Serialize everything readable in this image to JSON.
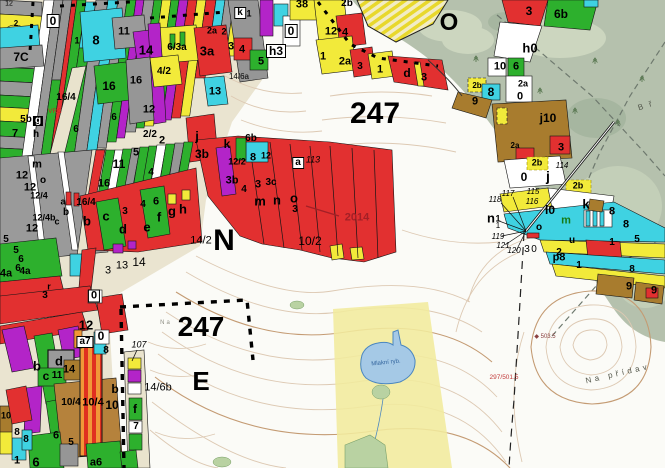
{
  "map": {
    "type": "forest-management-cadastral-map",
    "palette": {
      "parcel_red": "#e23030",
      "parcel_green": "#2db02d",
      "parcel_cyan": "#3fd2e2",
      "parcel_yellow": "#f2ea3a",
      "parcel_gray": "#9a9a9a",
      "parcel_magenta": "#b324c8",
      "parcel_brown": "#a87c2e",
      "parcel_ochre": "#b5823c",
      "stripe_orange": "#f09838",
      "road_beige": "#e9e3cd",
      "outside_green": "#b5c1ad",
      "meadow_band_yellow": "#f1eb9d",
      "pond_blue": "#a5c9e6",
      "contour_light": "#ddc9b3",
      "contour_index": "#c49b73",
      "year_marker_red": "#a31f26"
    },
    "big_labels": [
      "247",
      "N",
      "247",
      "E",
      "O"
    ],
    "year_marker": "2014",
    "pond_name": "Mlakní ryb.",
    "place_names": [
      "Na přídav",
      "B ř",
      "Na"
    ],
    "spot_heights": [
      "◆ 503.5",
      "297/501.5"
    ],
    "labels": [
      {
        "t": "247",
        "x": 375,
        "y": 114,
        "s": 30
      },
      {
        "t": "N",
        "x": 224,
        "y": 241,
        "s": 30
      },
      {
        "t": "247",
        "x": 201,
        "y": 327,
        "s": 28
      },
      {
        "t": "E",
        "x": 201,
        "y": 381,
        "s": 26
      },
      {
        "t": "O",
        "x": 449,
        "y": 23,
        "s": 24
      },
      {
        "t": "2014",
        "x": 357,
        "y": 218,
        "s": 11,
        "c": "#a31f26"
      },
      {
        "t": "12",
        "x": 9,
        "y": 4,
        "s": 7,
        "w": "n"
      },
      {
        "t": "2",
        "x": 16,
        "y": 24,
        "s": 8
      },
      {
        "t": "0",
        "x": 53,
        "y": 21,
        "s": 12,
        "bx": 1
      },
      {
        "t": "8",
        "x": 96,
        "y": 40,
        "s": 13
      },
      {
        "t": "1",
        "x": 77,
        "y": 41,
        "s": 9
      },
      {
        "t": "11",
        "x": 124,
        "y": 32,
        "s": 11
      },
      {
        "t": "14",
        "x": 146,
        "y": 50,
        "s": 13
      },
      {
        "t": "6/3a",
        "x": 177,
        "y": 48,
        "s": 10
      },
      {
        "t": "3a",
        "x": 207,
        "y": 51,
        "s": 13
      },
      {
        "t": "2a",
        "x": 212,
        "y": 31,
        "s": 9
      },
      {
        "t": "2",
        "x": 224,
        "y": 32,
        "s": 9
      },
      {
        "t": "k",
        "x": 240,
        "y": 13,
        "s": 10,
        "bx": 1
      },
      {
        "t": "1",
        "x": 249,
        "y": 14,
        "s": 9
      },
      {
        "t": "7C",
        "x": 21,
        "y": 57,
        "s": 12
      },
      {
        "t": "16",
        "x": 109,
        "y": 86,
        "s": 12
      },
      {
        "t": "16",
        "x": 136,
        "y": 81,
        "s": 11
      },
      {
        "t": "13",
        "x": 215,
        "y": 92,
        "s": 11
      },
      {
        "t": "4/2",
        "x": 164,
        "y": 72,
        "s": 10
      },
      {
        "t": "12",
        "x": 149,
        "y": 110,
        "s": 11
      },
      {
        "t": "16/4",
        "x": 66,
        "y": 98,
        "s": 10
      },
      {
        "t": "5b",
        "x": 26,
        "y": 120,
        "s": 10
      },
      {
        "t": "g",
        "x": 38,
        "y": 121,
        "s": 10,
        "inv": 1
      },
      {
        "t": "VRC",
        "x": 55,
        "y": 112,
        "s": 6.5,
        "c": "#cc2222",
        "w": "n"
      },
      {
        "t": "7",
        "x": 15,
        "y": 134,
        "s": 11
      },
      {
        "t": "h",
        "x": 36,
        "y": 135,
        "s": 10
      },
      {
        "t": "6",
        "x": 76,
        "y": 130,
        "s": 10
      },
      {
        "t": "6",
        "x": 114,
        "y": 118,
        "s": 10
      },
      {
        "t": "2/2",
        "x": 150,
        "y": 135,
        "s": 10
      },
      {
        "t": "2",
        "x": 162,
        "y": 141,
        "s": 11
      },
      {
        "t": "j",
        "x": 197,
        "y": 136,
        "s": 13
      },
      {
        "t": "3b",
        "x": 202,
        "y": 154,
        "s": 12
      },
      {
        "t": "14/6a",
        "x": 239,
        "y": 77,
        "s": 8,
        "w": "n"
      },
      {
        "t": "4",
        "x": 242,
        "y": 50,
        "s": 11
      },
      {
        "t": "3",
        "x": 231,
        "y": 47,
        "s": 11
      },
      {
        "t": "5",
        "x": 261,
        "y": 62,
        "s": 11
      },
      {
        "t": "6b",
        "x": 251,
        "y": 139,
        "s": 10
      },
      {
        "t": "h3",
        "x": 276,
        "y": 51,
        "s": 12,
        "bx": 1
      },
      {
        "t": "38",
        "x": 302,
        "y": 5,
        "s": 11
      },
      {
        "t": "0",
        "x": 291,
        "y": 31,
        "s": 12,
        "bx": 1
      },
      {
        "t": "12",
        "x": 331,
        "y": 32,
        "s": 11
      },
      {
        "t": "4",
        "x": 345,
        "y": 33,
        "s": 11
      },
      {
        "t": "2b",
        "x": 347,
        "y": 4,
        "s": 10
      },
      {
        "t": "1",
        "x": 323,
        "y": 57,
        "s": 11
      },
      {
        "t": "2a",
        "x": 345,
        "y": 62,
        "s": 11
      },
      {
        "t": "3",
        "x": 360,
        "y": 67,
        "s": 10
      },
      {
        "t": "1",
        "x": 380,
        "y": 70,
        "s": 11
      },
      {
        "t": "d",
        "x": 407,
        "y": 73,
        "s": 12
      },
      {
        "t": "3",
        "x": 424,
        "y": 78,
        "s": 11
      },
      {
        "t": "k",
        "x": 227,
        "y": 144,
        "s": 12
      },
      {
        "t": "12/2",
        "x": 237,
        "y": 162,
        "s": 9
      },
      {
        "t": "8",
        "x": 253,
        "y": 158,
        "s": 11
      },
      {
        "t": "12",
        "x": 266,
        "y": 156,
        "s": 9
      },
      {
        "t": "3b",
        "x": 232,
        "y": 181,
        "s": 11
      },
      {
        "t": "4",
        "x": 244,
        "y": 190,
        "s": 10
      },
      {
        "t": "3",
        "x": 258,
        "y": 185,
        "s": 11
      },
      {
        "t": "3c",
        "x": 271,
        "y": 183,
        "s": 10
      },
      {
        "t": "m",
        "x": 260,
        "y": 201,
        "s": 13
      },
      {
        "t": "n",
        "x": 277,
        "y": 200,
        "s": 13
      },
      {
        "t": "o",
        "x": 294,
        "y": 198,
        "s": 13
      },
      {
        "t": "3",
        "x": 295,
        "y": 210,
        "s": 10
      },
      {
        "t": "a",
        "x": 298,
        "y": 163,
        "s": 10,
        "bx": 1
      },
      {
        "t": "113",
        "x": 313,
        "y": 160,
        "s": 9,
        "i": 1,
        "w": "n"
      },
      {
        "t": "14/2",
        "x": 201,
        "y": 241,
        "s": 11,
        "w": "n"
      },
      {
        "t": "10/2",
        "x": 310,
        "y": 241,
        "s": 12,
        "w": "n"
      },
      {
        "t": "3",
        "x": 108,
        "y": 271,
        "s": 11,
        "w": "n"
      },
      {
        "t": "13",
        "x": 122,
        "y": 266,
        "s": 11,
        "w": "n"
      },
      {
        "t": "14",
        "x": 139,
        "y": 262,
        "s": 12,
        "w": "n"
      },
      {
        "t": "Na",
        "x": 166,
        "y": 323,
        "s": 6,
        "c": "#8f8f85",
        "ls": 2,
        "w": "n"
      },
      {
        "t": "m",
        "x": 37,
        "y": 165,
        "s": 11
      },
      {
        "t": "12",
        "x": 22,
        "y": 176,
        "s": 11
      },
      {
        "t": "o",
        "x": 43,
        "y": 181,
        "s": 10
      },
      {
        "t": "12",
        "x": 30,
        "y": 188,
        "s": 11
      },
      {
        "t": "12/4",
        "x": 39,
        "y": 196,
        "s": 9
      },
      {
        "t": "12/4b",
        "x": 44,
        "y": 218,
        "s": 9
      },
      {
        "t": "12",
        "x": 32,
        "y": 229,
        "s": 11
      },
      {
        "t": "5",
        "x": 6,
        "y": 240,
        "s": 10
      },
      {
        "t": "5",
        "x": 16,
        "y": 251,
        "s": 10
      },
      {
        "t": "6",
        "x": 21,
        "y": 260,
        "s": 10
      },
      {
        "t": "6",
        "x": 18,
        "y": 269,
        "s": 10
      },
      {
        "t": "4a",
        "x": 6,
        "y": 274,
        "s": 11
      },
      {
        "t": "4a",
        "x": 25,
        "y": 272,
        "s": 10
      },
      {
        "t": "3",
        "x": 45,
        "y": 296,
        "s": 10
      },
      {
        "t": "r",
        "x": 49,
        "y": 287,
        "s": 9
      },
      {
        "t": "16/4",
        "x": 86,
        "y": 203,
        "s": 10
      },
      {
        "t": "a",
        "x": 63,
        "y": 202,
        "s": 9
      },
      {
        "t": "b",
        "x": 66,
        "y": 213,
        "s": 10
      },
      {
        "t": "c",
        "x": 57,
        "y": 222,
        "s": 9
      },
      {
        "t": "b",
        "x": 87,
        "y": 221,
        "s": 13
      },
      {
        "t": "c",
        "x": 106,
        "y": 216,
        "s": 13
      },
      {
        "t": "d",
        "x": 123,
        "y": 229,
        "s": 13
      },
      {
        "t": "e",
        "x": 147,
        "y": 227,
        "s": 13
      },
      {
        "t": "f",
        "x": 159,
        "y": 217,
        "s": 13
      },
      {
        "t": "g",
        "x": 172,
        "y": 211,
        "s": 13
      },
      {
        "t": "h",
        "x": 183,
        "y": 209,
        "s": 13
      },
      {
        "t": "3",
        "x": 125,
        "y": 212,
        "s": 10
      },
      {
        "t": "4",
        "x": 143,
        "y": 205,
        "s": 10
      },
      {
        "t": "6",
        "x": 156,
        "y": 202,
        "s": 11
      },
      {
        "t": "4",
        "x": 151,
        "y": 173,
        "s": 10
      },
      {
        "t": "11",
        "x": 119,
        "y": 164,
        "s": 12
      },
      {
        "t": "16",
        "x": 104,
        "y": 184,
        "s": 11
      },
      {
        "t": "5",
        "x": 136,
        "y": 153,
        "s": 11
      },
      {
        "t": "0",
        "x": 94,
        "y": 296,
        "s": 11,
        "bx": 1
      },
      {
        "t": "12",
        "x": 86,
        "y": 325,
        "s": 13
      },
      {
        "t": "a7",
        "x": 85,
        "y": 342,
        "s": 10,
        "bx": 1
      },
      {
        "t": "0",
        "x": 101,
        "y": 336,
        "s": 12
      },
      {
        "t": "8",
        "x": 106,
        "y": 351,
        "s": 10
      },
      {
        "t": "b",
        "x": 37,
        "y": 366,
        "s": 13
      },
      {
        "t": "d",
        "x": 59,
        "y": 361,
        "s": 13
      },
      {
        "t": "c",
        "x": 46,
        "y": 376,
        "s": 12
      },
      {
        "t": "11",
        "x": 57,
        "y": 376,
        "s": 10
      },
      {
        "t": "14",
        "x": 69,
        "y": 370,
        "s": 11
      },
      {
        "t": "10/4",
        "x": 71,
        "y": 403,
        "s": 10
      },
      {
        "t": "10/4",
        "x": 93,
        "y": 403,
        "s": 11
      },
      {
        "t": "10",
        "x": 112,
        "y": 405,
        "s": 12
      },
      {
        "t": "b",
        "x": 115,
        "y": 389,
        "s": 12
      },
      {
        "t": "f",
        "x": 135,
        "y": 409,
        "s": 12
      },
      {
        "t": "7",
        "x": 136,
        "y": 427,
        "s": 10
      },
      {
        "t": "5",
        "x": 71,
        "y": 443,
        "s": 10
      },
      {
        "t": "6",
        "x": 56,
        "y": 436,
        "s": 11
      },
      {
        "t": "6",
        "x": 36,
        "y": 462,
        "s": 13
      },
      {
        "t": "1",
        "x": 17,
        "y": 461,
        "s": 11
      },
      {
        "t": "a6",
        "x": 96,
        "y": 463,
        "s": 11
      },
      {
        "t": "8",
        "x": 17,
        "y": 433,
        "s": 10
      },
      {
        "t": "8",
        "x": 26,
        "y": 440,
        "s": 10
      },
      {
        "t": "10",
        "x": 6,
        "y": 416,
        "s": 9
      },
      {
        "t": "107",
        "x": 139,
        "y": 345,
        "s": 9,
        "i": 1,
        "w": "n"
      },
      {
        "t": "14/6b",
        "x": 158,
        "y": 388,
        "s": 11,
        "w": "n"
      },
      {
        "t": "3",
        "x": 529,
        "y": 11,
        "s": 12
      },
      {
        "t": "6b",
        "x": 561,
        "y": 14,
        "s": 12
      },
      {
        "t": "h0",
        "x": 530,
        "y": 48,
        "s": 13
      },
      {
        "t": "10",
        "x": 500,
        "y": 67,
        "s": 11
      },
      {
        "t": "6",
        "x": 516,
        "y": 67,
        "s": 11
      },
      {
        "t": "2b",
        "x": 477,
        "y": 86,
        "s": 8
      },
      {
        "t": "8",
        "x": 491,
        "y": 92,
        "s": 12
      },
      {
        "t": "9",
        "x": 475,
        "y": 102,
        "s": 11
      },
      {
        "t": "2a",
        "x": 523,
        "y": 84,
        "s": 9
      },
      {
        "t": "0",
        "x": 520,
        "y": 97,
        "s": 11
      },
      {
        "t": "j10",
        "x": 548,
        "y": 118,
        "s": 12
      },
      {
        "t": "2a",
        "x": 515,
        "y": 146,
        "s": 8
      },
      {
        "t": "3",
        "x": 561,
        "y": 148,
        "s": 11
      },
      {
        "t": "2b",
        "x": 537,
        "y": 163,
        "s": 9
      },
      {
        "t": "114",
        "x": 562,
        "y": 166,
        "s": 8,
        "i": 1,
        "w": "n"
      },
      {
        "t": "0",
        "x": 524,
        "y": 177,
        "s": 12
      },
      {
        "t": "j",
        "x": 548,
        "y": 176,
        "s": 14
      },
      {
        "t": "2b",
        "x": 578,
        "y": 186,
        "s": 9
      },
      {
        "t": "115",
        "x": 533,
        "y": 192,
        "s": 8,
        "i": 1,
        "w": "n"
      },
      {
        "t": "117",
        "x": 508,
        "y": 194,
        "s": 8,
        "i": 1,
        "w": "n"
      },
      {
        "t": "118",
        "x": 495,
        "y": 200,
        "s": 8,
        "i": 1,
        "w": "n"
      },
      {
        "t": "116",
        "x": 532,
        "y": 202,
        "s": 8,
        "i": 1,
        "w": "n"
      },
      {
        "t": "n",
        "x": 491,
        "y": 218,
        "s": 13
      },
      {
        "t": "1",
        "x": 498,
        "y": 219,
        "s": 9
      },
      {
        "t": "1",
        "x": 498,
        "y": 226,
        "s": 8,
        "w": "n"
      },
      {
        "t": "119",
        "x": 498,
        "y": 237,
        "s": 8,
        "i": 1,
        "w": "n"
      },
      {
        "t": "121",
        "x": 503,
        "y": 246,
        "s": 8,
        "i": 1,
        "w": "n"
      },
      {
        "t": "120",
        "x": 514,
        "y": 251,
        "s": 8,
        "i": 1,
        "w": "n"
      },
      {
        "t": "3",
        "x": 527,
        "y": 250,
        "s": 10,
        "w": "n"
      },
      {
        "t": "0",
        "x": 534,
        "y": 250,
        "s": 10,
        "w": "n"
      },
      {
        "t": "p8",
        "x": 559,
        "y": 258,
        "s": 11
      },
      {
        "t": "k",
        "x": 586,
        "y": 204,
        "s": 13
      },
      {
        "t": "l0",
        "x": 550,
        "y": 210,
        "s": 12
      },
      {
        "t": "m",
        "x": 566,
        "y": 221,
        "s": 11,
        "c": "#157a15"
      },
      {
        "t": "o",
        "x": 539,
        "y": 228,
        "s": 10
      },
      {
        "t": "u",
        "x": 572,
        "y": 241,
        "s": 10
      },
      {
        "t": "8",
        "x": 612,
        "y": 212,
        "s": 11
      },
      {
        "t": "8",
        "x": 626,
        "y": 225,
        "s": 11
      },
      {
        "t": "1",
        "x": 612,
        "y": 243,
        "s": 10
      },
      {
        "t": "5",
        "x": 637,
        "y": 240,
        "s": 10
      },
      {
        "t": "2",
        "x": 559,
        "y": 253,
        "s": 10
      },
      {
        "t": "1",
        "x": 579,
        "y": 266,
        "s": 10
      },
      {
        "t": "8",
        "x": 632,
        "y": 270,
        "s": 10
      },
      {
        "t": "9",
        "x": 629,
        "y": 287,
        "s": 11
      },
      {
        "t": "9",
        "x": 654,
        "y": 291,
        "s": 11
      },
      {
        "t": "B ř",
        "x": 646,
        "y": 106,
        "s": 8,
        "c": "#555a4e",
        "ls": 2,
        "r": -18,
        "w": "n"
      },
      {
        "t": "Na přídav",
        "x": 618,
        "y": 374,
        "s": 8,
        "c": "#55584c",
        "ls": 3.5,
        "r": -13,
        "w": "n"
      },
      {
        "t": "◆ 503.5",
        "x": 545,
        "y": 337,
        "s": 6,
        "c": "#8a4040",
        "w": "n"
      },
      {
        "t": "297/501.5",
        "x": 504,
        "y": 378,
        "s": 6.5,
        "c": "#c23a3a",
        "w": "n"
      },
      {
        "t": "Mlakní ryb.",
        "x": 386,
        "y": 363,
        "s": 6,
        "c": "#33659e",
        "r": -6,
        "w": "n"
      }
    ]
  }
}
